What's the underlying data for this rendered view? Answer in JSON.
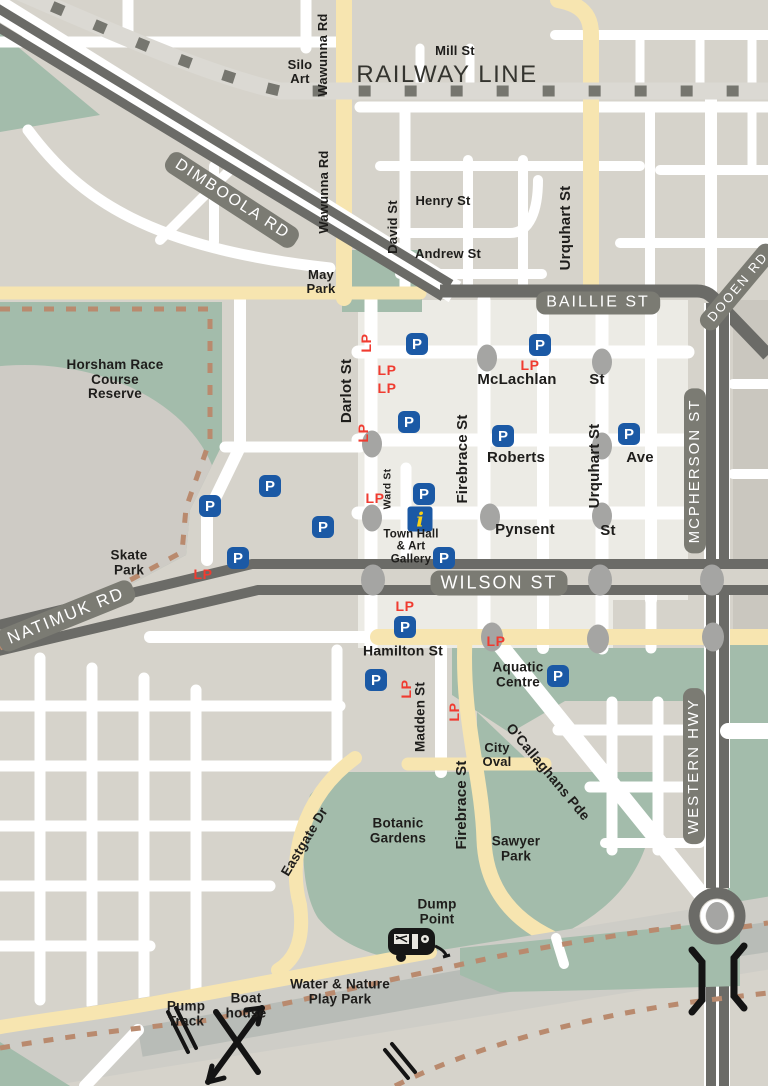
{
  "map": {
    "colors": {
      "background": "#d6d3cb",
      "cbd_block": "#ecebe5",
      "east_block": "#cac7bf",
      "park_green": "#a3bcab",
      "cream_road": "#f7e5b0",
      "major_road": "#6b6b67",
      "road_pill": "#7b7b73",
      "railway_band": "#dbd9d3",
      "railway_dash": "#76766f",
      "river": "#b8bcb7",
      "floodplain": "#cecdc7",
      "trail_dash": "#b98a6e",
      "parking_blue": "#1b59a5",
      "long_parking_red": "#f03b30",
      "intersection_gray": "#a5a5a3",
      "info_yellow": "#f6cf16"
    },
    "symbols": {
      "parking": "P",
      "long_parking": "LP",
      "info": "i"
    },
    "labels": [
      {
        "n": "railway-line",
        "t": "RAILWAY LINE",
        "x": 447,
        "y": 75,
        "r": 0,
        "fs": 24,
        "cls": "rail"
      },
      {
        "n": "dimboola-rd",
        "t": "DIMBOOLA RD",
        "x": 232,
        "y": 200,
        "r": 33,
        "fs": 16,
        "cls": "pill"
      },
      {
        "n": "baillie-st",
        "t": "BAILLIE ST",
        "x": 598,
        "y": 303,
        "r": 0,
        "fs": 16,
        "cls": "pill"
      },
      {
        "n": "dooen-rd",
        "t": "DOOEN RD",
        "x": 738,
        "y": 287,
        "r": -50,
        "fs": 13,
        "cls": "pill"
      },
      {
        "n": "wilson-st",
        "t": "WILSON ST",
        "x": 499,
        "y": 583,
        "r": 0,
        "fs": 18,
        "cls": "pill"
      },
      {
        "n": "natimuk-rd",
        "t": "NATIMUK RD",
        "x": 66,
        "y": 616,
        "r": -22,
        "fs": 17,
        "cls": "pill"
      },
      {
        "n": "mcpherson-st",
        "t": "MCPHERSON ST",
        "x": 695,
        "y": 471,
        "r": -90,
        "fs": 15,
        "cls": "pill"
      },
      {
        "n": "western-hwy",
        "t": "WESTERN HWY",
        "x": 694,
        "y": 766,
        "r": -90,
        "fs": 15,
        "cls": "pill"
      },
      {
        "n": "silo-art",
        "t": "Silo\nArt",
        "x": 300,
        "y": 72,
        "r": 0,
        "fs": 13,
        "cls": "blk"
      },
      {
        "n": "wawunna-rd-north",
        "t": "Wawunna Rd",
        "x": 323,
        "y": 55,
        "r": -90,
        "fs": 13,
        "cls": "blk"
      },
      {
        "n": "mill-st",
        "t": "Mill St",
        "x": 455,
        "y": 51,
        "r": 0,
        "fs": 13,
        "cls": "blk"
      },
      {
        "n": "wawunna-rd",
        "t": "Wawunna Rd",
        "x": 324,
        "y": 192,
        "r": -90,
        "fs": 13,
        "cls": "blk"
      },
      {
        "n": "david-st",
        "t": "David St",
        "x": 393,
        "y": 227,
        "r": -90,
        "fs": 13,
        "cls": "blk"
      },
      {
        "n": "henry-st",
        "t": "Henry St",
        "x": 443,
        "y": 201,
        "r": 0,
        "fs": 13,
        "cls": "blk"
      },
      {
        "n": "andrew-st",
        "t": "Andrew St",
        "x": 448,
        "y": 254,
        "r": 0,
        "fs": 13,
        "cls": "blk"
      },
      {
        "n": "urquhart-st-north",
        "t": "Urquhart St",
        "x": 566,
        "y": 228,
        "r": -90,
        "fs": 15,
        "cls": "blk"
      },
      {
        "n": "may-park",
        "t": "May\nPark",
        "x": 321,
        "y": 282,
        "r": 0,
        "fs": 13,
        "cls": "blk"
      },
      {
        "n": "horsham-race-course-reserve",
        "t": "Horsham Race\nCourse\nReserve",
        "x": 115,
        "y": 380,
        "r": 0,
        "fs": 13.5,
        "cls": "blk"
      },
      {
        "n": "darlot-st",
        "t": "Darlot St",
        "x": 347,
        "y": 391,
        "r": -90,
        "fs": 15,
        "cls": "blk"
      },
      {
        "n": "mclachlan",
        "t": "McLachlan",
        "x": 517,
        "y": 380,
        "r": 0,
        "fs": 15,
        "cls": "blk"
      },
      {
        "n": "mclachlan-st-suffix",
        "t": "St",
        "x": 597,
        "y": 380,
        "r": 0,
        "fs": 15,
        "cls": "blk"
      },
      {
        "n": "firebrace-st",
        "t": "Firebrace St",
        "x": 463,
        "y": 459,
        "r": -90,
        "fs": 15,
        "cls": "blk"
      },
      {
        "n": "roberts",
        "t": "Roberts",
        "x": 516,
        "y": 458,
        "r": 0,
        "fs": 15,
        "cls": "blk"
      },
      {
        "n": "roberts-ave-suffix",
        "t": "Ave",
        "x": 640,
        "y": 458,
        "r": 0,
        "fs": 15,
        "cls": "blk"
      },
      {
        "n": "urquhart-st",
        "t": "Urquhart St",
        "x": 595,
        "y": 466,
        "r": -90,
        "fs": 15,
        "cls": "blk"
      },
      {
        "n": "ward-st",
        "t": "Ward St",
        "x": 388,
        "y": 489,
        "r": -90,
        "fs": 10.5,
        "cls": "blk"
      },
      {
        "n": "pynsent",
        "t": "Pynsent",
        "x": 525,
        "y": 530,
        "r": 0,
        "fs": 15,
        "cls": "blk"
      },
      {
        "n": "pynsent-st-suffix",
        "t": "St",
        "x": 608,
        "y": 531,
        "r": 0,
        "fs": 15,
        "cls": "blk"
      },
      {
        "n": "town-hall-art-gallery",
        "t": "Town Hall\n& Art\nGallery",
        "x": 411,
        "y": 547,
        "r": 0,
        "fs": 11.5,
        "cls": "blk"
      },
      {
        "n": "skate-park",
        "t": "Skate\nPark",
        "x": 129,
        "y": 563,
        "r": 0,
        "fs": 13.5,
        "cls": "blk"
      },
      {
        "n": "hamilton-st",
        "t": "Hamilton St",
        "x": 403,
        "y": 651,
        "r": 0,
        "fs": 14,
        "cls": "blk"
      },
      {
        "n": "aquatic-centre",
        "t": "Aquatic\nCentre",
        "x": 518,
        "y": 675,
        "r": 0,
        "fs": 13.5,
        "cls": "blk"
      },
      {
        "n": "madden-st",
        "t": "Madden St",
        "x": 421,
        "y": 717,
        "r": -90,
        "fs": 13.5,
        "cls": "blk"
      },
      {
        "n": "city-oval",
        "t": "City\nOval",
        "x": 497,
        "y": 755,
        "r": 0,
        "fs": 13,
        "cls": "blk"
      },
      {
        "n": "ocallaghans-pde",
        "t": "O'Callaghans Pde",
        "x": 548,
        "y": 772,
        "r": 50,
        "fs": 14,
        "cls": "blk"
      },
      {
        "n": "firebrace-st-south",
        "t": "Firebrace St",
        "x": 462,
        "y": 805,
        "r": -90,
        "fs": 15,
        "cls": "blk"
      },
      {
        "n": "botanic-gardens",
        "t": "Botanic\nGardens",
        "x": 398,
        "y": 831,
        "r": 0,
        "fs": 13.5,
        "cls": "blk"
      },
      {
        "n": "eastgate-dr",
        "t": "Eastgate Dr",
        "x": 305,
        "y": 842,
        "r": -59,
        "fs": 13.5,
        "cls": "blk"
      },
      {
        "n": "sawyer-park",
        "t": "Sawyer\nPark",
        "x": 516,
        "y": 849,
        "r": 0,
        "fs": 13.5,
        "cls": "blk"
      },
      {
        "n": "dump-point",
        "t": "Dump\nPoint",
        "x": 437,
        "y": 912,
        "r": 0,
        "fs": 13.5,
        "cls": "blk"
      },
      {
        "n": "water-nature-play-park",
        "t": "Water & Nature\nPlay Park",
        "x": 340,
        "y": 992,
        "r": 0,
        "fs": 13.5,
        "cls": "blk"
      },
      {
        "n": "pump-track",
        "t": "Pump\nTrack",
        "x": 186,
        "y": 1014,
        "r": 0,
        "fs": 13.5,
        "cls": "blk"
      },
      {
        "n": "boat-house",
        "t": "Boat\nhouse",
        "x": 246,
        "y": 1006,
        "r": 0,
        "fs": 13.5,
        "cls": "blk"
      }
    ],
    "parking_markers": [
      {
        "x": 417,
        "y": 344
      },
      {
        "x": 540,
        "y": 345
      },
      {
        "x": 409,
        "y": 422
      },
      {
        "x": 503,
        "y": 436
      },
      {
        "x": 629,
        "y": 434
      },
      {
        "x": 270,
        "y": 486
      },
      {
        "x": 424,
        "y": 494
      },
      {
        "x": 210,
        "y": 506
      },
      {
        "x": 323,
        "y": 527
      },
      {
        "x": 238,
        "y": 558
      },
      {
        "x": 444,
        "y": 558
      },
      {
        "x": 405,
        "y": 627
      },
      {
        "x": 376,
        "y": 680
      },
      {
        "x": 558,
        "y": 676
      }
    ],
    "long_parking_markers": [
      {
        "x": 366,
        "y": 343,
        "r": -90
      },
      {
        "x": 387,
        "y": 370,
        "r": 0
      },
      {
        "x": 387,
        "y": 388,
        "r": 0
      },
      {
        "x": 363,
        "y": 433,
        "r": -90
      },
      {
        "x": 530,
        "y": 365,
        "r": 0
      },
      {
        "x": 375,
        "y": 498,
        "r": 0
      },
      {
        "x": 203,
        "y": 574,
        "r": 0
      },
      {
        "x": 405,
        "y": 606,
        "r": 0
      },
      {
        "x": 496,
        "y": 641,
        "r": 0
      },
      {
        "x": 406,
        "y": 689,
        "r": -90
      },
      {
        "x": 454,
        "y": 712,
        "r": -90
      }
    ],
    "intersection_dots": [
      {
        "x": 487,
        "y": 358,
        "w": 20,
        "h": 27
      },
      {
        "x": 602,
        "y": 362,
        "w": 20,
        "h": 27
      },
      {
        "x": 372,
        "y": 444,
        "w": 20,
        "h": 27
      },
      {
        "x": 602,
        "y": 446,
        "w": 20,
        "h": 27
      },
      {
        "x": 372,
        "y": 518,
        "w": 20,
        "h": 27
      },
      {
        "x": 490,
        "y": 517,
        "w": 20,
        "h": 27
      },
      {
        "x": 602,
        "y": 516,
        "w": 20,
        "h": 27
      },
      {
        "x": 373,
        "y": 580,
        "w": 24,
        "h": 31
      },
      {
        "x": 600,
        "y": 580,
        "w": 24,
        "h": 31
      },
      {
        "x": 712,
        "y": 580,
        "w": 24,
        "h": 31
      },
      {
        "x": 492,
        "y": 637,
        "w": 22,
        "h": 29
      },
      {
        "x": 598,
        "y": 639,
        "w": 22,
        "h": 29
      },
      {
        "x": 713,
        "y": 637,
        "w": 22,
        "h": 29
      }
    ],
    "info_point": {
      "x": 420,
      "y": 519
    }
  }
}
